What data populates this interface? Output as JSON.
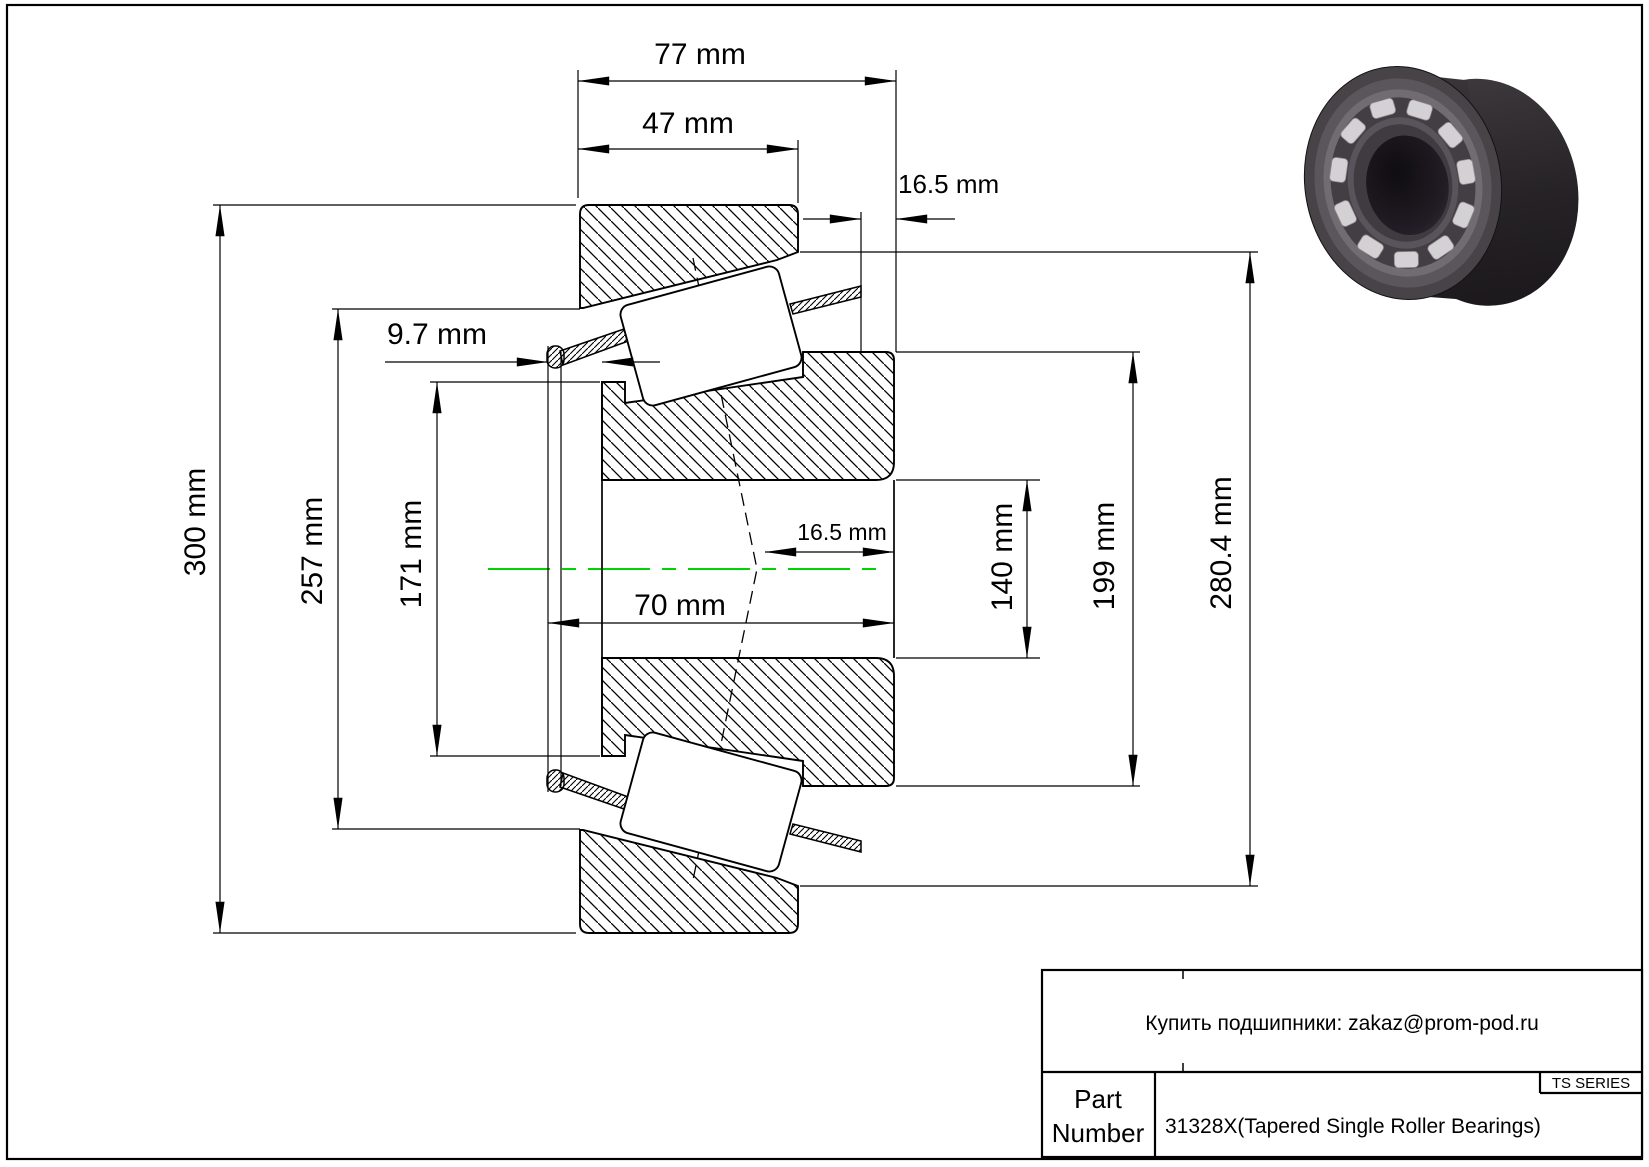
{
  "page": {
    "background": "#ffffff",
    "border_color": "#000000"
  },
  "drawing": {
    "type": "tapered-roller-bearing-cross-section",
    "centerline_color": "#00d400",
    "dimensions": {
      "width_total": {
        "label": "77 mm"
      },
      "cup_width": {
        "label": "47 mm"
      },
      "standout_top": {
        "label": "16.5 mm"
      },
      "cage_standout": {
        "label": "9.7 mm"
      },
      "outer_diameter": {
        "label": "300 mm"
      },
      "cup_race_dia": {
        "label": "257 mm"
      },
      "cone_front_dia": {
        "label": "171 mm"
      },
      "cone_width": {
        "label": "70 mm"
      },
      "center_offset": {
        "label": "16.5 mm"
      },
      "bore_diameter": {
        "label": "140 mm"
      },
      "cone_rib_dia": {
        "label": "199 mm"
      },
      "cup_bore_dia": {
        "label": "280.4 mm"
      }
    }
  },
  "title_block": {
    "contact": "Купить подшипники: zakaz@prom-pod.ru",
    "series": "TS SERIES",
    "part_label_line1": "Part",
    "part_label_line2": "Number",
    "part_value": "31328X(Tapered Single Roller Bearings)"
  }
}
